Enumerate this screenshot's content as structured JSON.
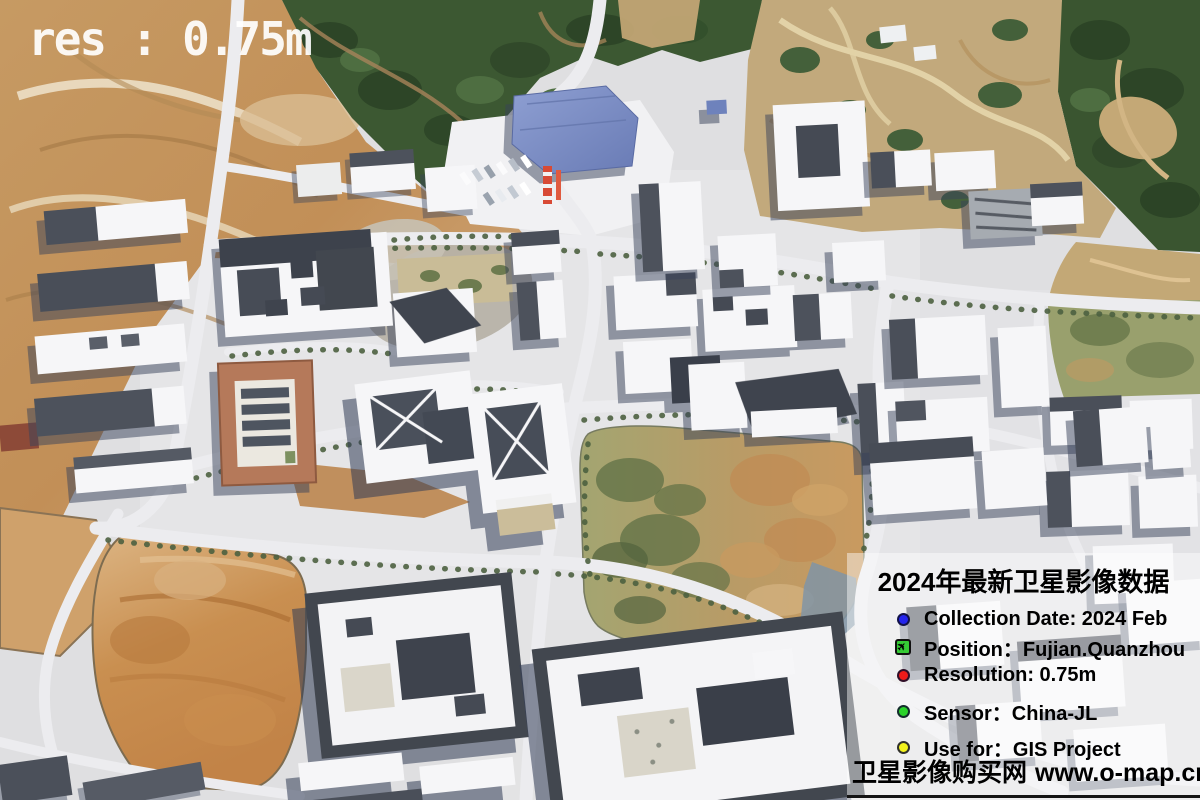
{
  "overlay": {
    "resolution_label": "res : 0.75m",
    "text_color": "#ffffff"
  },
  "info_panel": {
    "title": "2024年最新卫星影像数据",
    "haze_color": "rgba(255,255,255,0.45)",
    "underline_color": "#141414",
    "items": [
      {
        "icon": "blue-dot-icon",
        "color": "#2525ec",
        "label": "Collection Date: 2024 Feb"
      },
      {
        "icon": "airport-icon",
        "color": "#35cb35",
        "glyph": "✈",
        "label": "Position：Fujian.Quanzhou"
      },
      {
        "icon": "red-dot-icon",
        "color": "#ee1a1a",
        "label": "Resolution: 0.75m"
      },
      {
        "icon": "green-dot-icon",
        "color": "#2bd32b",
        "label": "Sensor：China-JL"
      },
      {
        "icon": "yellow-dot-icon",
        "color": "#f3f31c",
        "label": "Use for：GIS Project"
      }
    ],
    "footer": {
      "site_name": "卫星影像购买网",
      "site_url": "www.o-map.cn"
    }
  }
}
